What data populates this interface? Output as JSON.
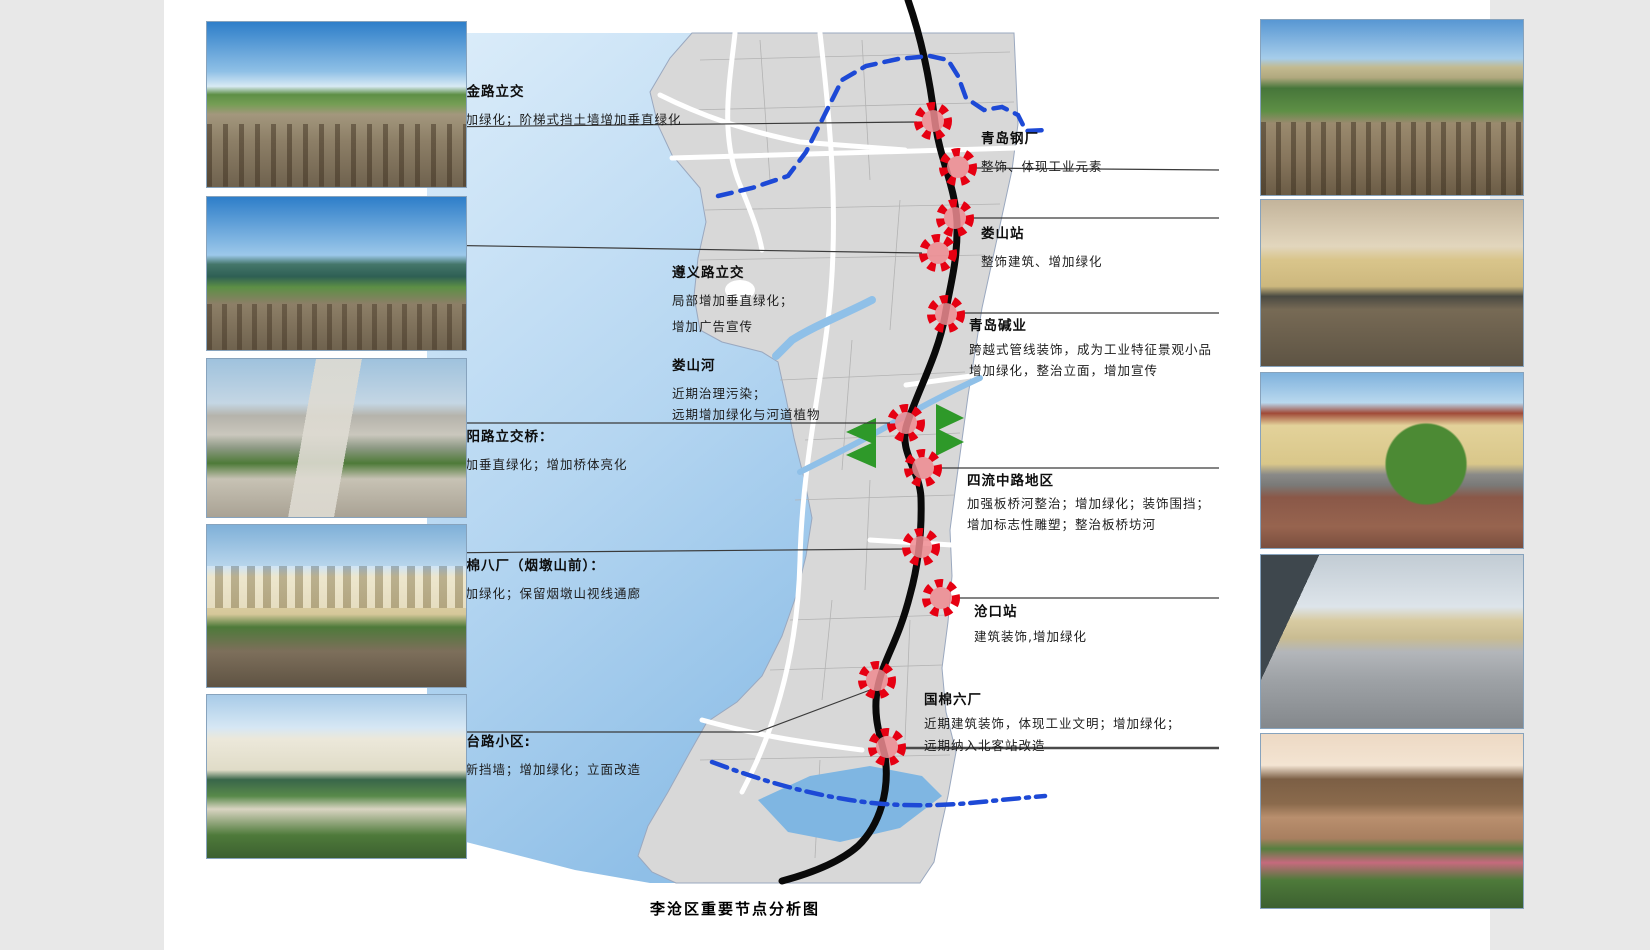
{
  "page": {
    "title": "李沧区重要节点分析图"
  },
  "colors": {
    "sea_top": "#d9ecfa",
    "sea_bottom": "#93c2e8",
    "land": "#d8d8d8",
    "railway": "#0a0a0a",
    "boundary_blue": "#1d49d6",
    "node_ring_red": "#e60012",
    "node_fill_pink": "#ef8b90",
    "river_blue": "#8fc0e8",
    "arrow_green": "#2e9929"
  },
  "anns_left": [
    {
      "title": "瑞金路立交",
      "l1": "增加绿化；阶梯式挡土墙增加垂直绿化"
    },
    {
      "title": "遵义路立交",
      "l1": "局部增加垂直绿化；",
      "l2": "增加广告宣传"
    },
    {
      "title": "娄山河",
      "l1": "近期治理污染；",
      "l2": "远期增加绿化与河道植物"
    },
    {
      "title": "浏阳路立交桥：",
      "l1": "增加垂直绿化；增加桥体亮化"
    },
    {
      "title": "国棉八厂（烟墩山前）：",
      "l1": "增加绿化；保留烟墩山视线通廊"
    },
    {
      "title": "沧台路小区:",
      "l1": "翻新挡墙；增加绿化；立面改造"
    }
  ],
  "anns_right": [
    {
      "title": "青岛钢厂",
      "l1": "整饰、体现工业元素"
    },
    {
      "title": "娄山站",
      "l1": "整饰建筑、增加绿化"
    },
    {
      "title": "青岛碱业",
      "l1": "跨越式管线装饰，成为工业特征景观小品",
      "l2": "增加绿化，整治立面，增加宣传"
    },
    {
      "title": "四流中路地区",
      "l1": "加强板桥河整治；增加绿化；装饰围挡；",
      "l2": "增加标志性雕塑；整治板桥坊河"
    },
    {
      "title": "沧口站",
      "l1": "建筑装饰,增加绿化"
    },
    {
      "title": "国棉六厂",
      "l1": "近期建筑装饰，体现工业文明；增加绿化；",
      "l2": "远期纳入北客站改造"
    }
  ],
  "photos_left": [
    {
      "desc": "railway-tracks-with-road-and-power-lines"
    },
    {
      "desc": "green-gas-holder-industrial-site-by-railway"
    },
    {
      "desc": "elevated-highway-viaduct-with-retaining-wall"
    },
    {
      "desc": "yellow-residential-buildings-beside-railway"
    },
    {
      "desc": "green-roof-residential-buildings-with-gardens"
    }
  ],
  "photos_right": [
    {
      "desc": "railway-tracks-with-factory-bridge-and-trees"
    },
    {
      "desc": "yellow-heritage-buildings-along-railway-fence"
    },
    {
      "desc": "yellow-apartment-block-red-roof-street-trees"
    },
    {
      "desc": "station-platform-with-canopy-and-buildings"
    },
    {
      "desc": "brown-building-fence-with-flower-beds"
    }
  ]
}
